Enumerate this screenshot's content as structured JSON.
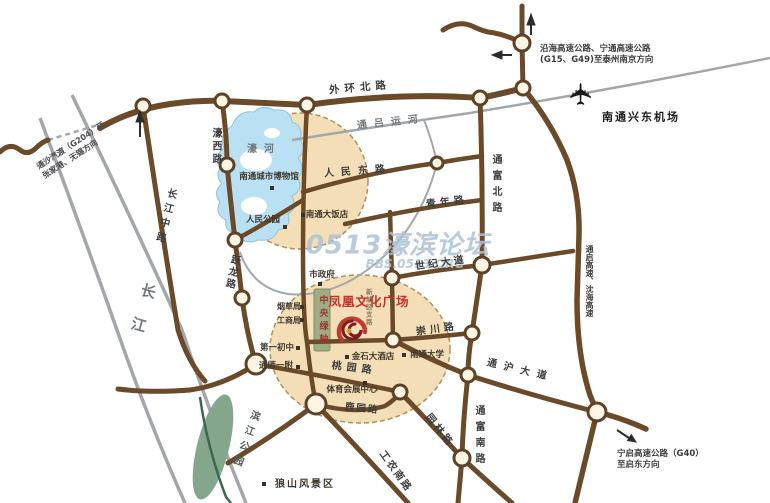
{
  "roads": {
    "waihuan_north": "外环北路",
    "tongfu_north": "通富北路",
    "tongfu_south": "通富南路",
    "qingnian": "青年路",
    "renmin_east": "人民东路",
    "shiji_avenue": "世纪大道",
    "chongchuan": "崇川路",
    "tonghu_avenue": "通沪大道",
    "yuanlin": "园林路",
    "gongnong_south": "工农南路",
    "luyuan": "鹿园路",
    "taoyuan": "桃园路",
    "changjiang_middle": "长江中路",
    "haoxi": "濠西路",
    "yuelong": "跃龙路",
    "xincheng_branch": "新城区支路"
  },
  "waterways": {
    "tonglu_canal": "通吕运河",
    "hao_river": "濠河",
    "changjiang": "长江"
  },
  "places": {
    "plaza_title": "凤凰文化广场",
    "central_green_axis": "中央绿轴",
    "museum": "南通城市博物馆",
    "renmin_park": "人民公园",
    "grand_hotel": "南通大饭店",
    "city_government": "市政府",
    "tobacco_bureau": "烟草局",
    "industry_commerce_bureau": "工商局",
    "first_junior_middle": "第一初中",
    "tongshi_first_affiliated": "通师一附",
    "jinshi_hotel": "金石大酒店",
    "nantong_university": "南通大学",
    "sports_expo_center": "体育会展中心",
    "binjiang_park": "滨江公园",
    "langshan_scenic": "狼山风景区",
    "airport": "南通兴东机场"
  },
  "annotations": {
    "ne_expressway_line1": "沿海高速公路、宁通高速公路",
    "ne_expressway_line2": "(G15、G49)至泰州南京方向",
    "se_expressway_line1": "宁启高速公路（G40）",
    "se_expressway_line2": "至启东方向",
    "ferry_line1": "通沙汽渡（G204）至",
    "ferry_line2": "张家港、无锡方向",
    "mid_expressway": "通启高速、沈海高速"
  },
  "watermark": {
    "main": "0513濠滨论坛",
    "sub": "BBS.0513.ORG"
  },
  "icons": {
    "airplane": "✈",
    "north_arrow": "up-arrow",
    "west_arrow": "left-arrow",
    "southeast_arrow": "down-right-arrow"
  },
  "colors": {
    "road_brown": "#6a4a28",
    "water_blue": "#b9e1f3",
    "plaza_tan": "#f2dcb3",
    "accent_red": "#c5302c",
    "green_axis": "#9dac82",
    "gray_line": "#a3a7ab"
  }
}
